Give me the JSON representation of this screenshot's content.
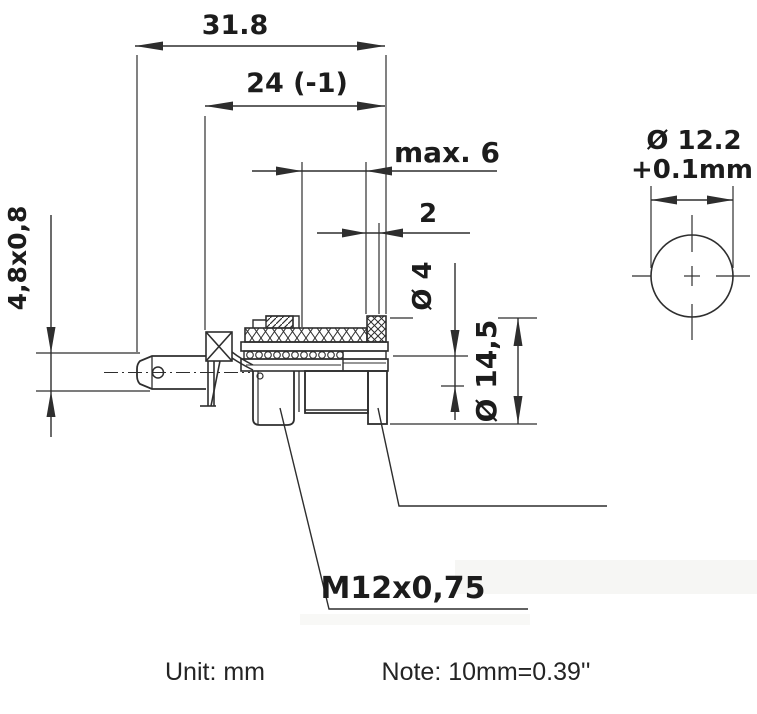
{
  "drawing": {
    "side_view": {
      "dim_length_total": "31.8",
      "dim_length_body": "24 (-1)",
      "dim_panel_max": "max. 6",
      "dim_gap": "2",
      "dim_bore": "Ø 4",
      "dim_flange": "Ø 14,5",
      "dim_tab": "4,8x0,8",
      "thread_callout": "M12x0,75"
    },
    "front_view": {
      "dim_hole": "Ø 12.2",
      "dim_tolerance": "+0.1mm"
    },
    "footer": {
      "unit": "Unit: mm",
      "note": "Note: 10mm=0.39''"
    },
    "colors": {
      "line": "#2e2e2e",
      "text": "#1c1c1c",
      "background": "#ffffff"
    }
  }
}
